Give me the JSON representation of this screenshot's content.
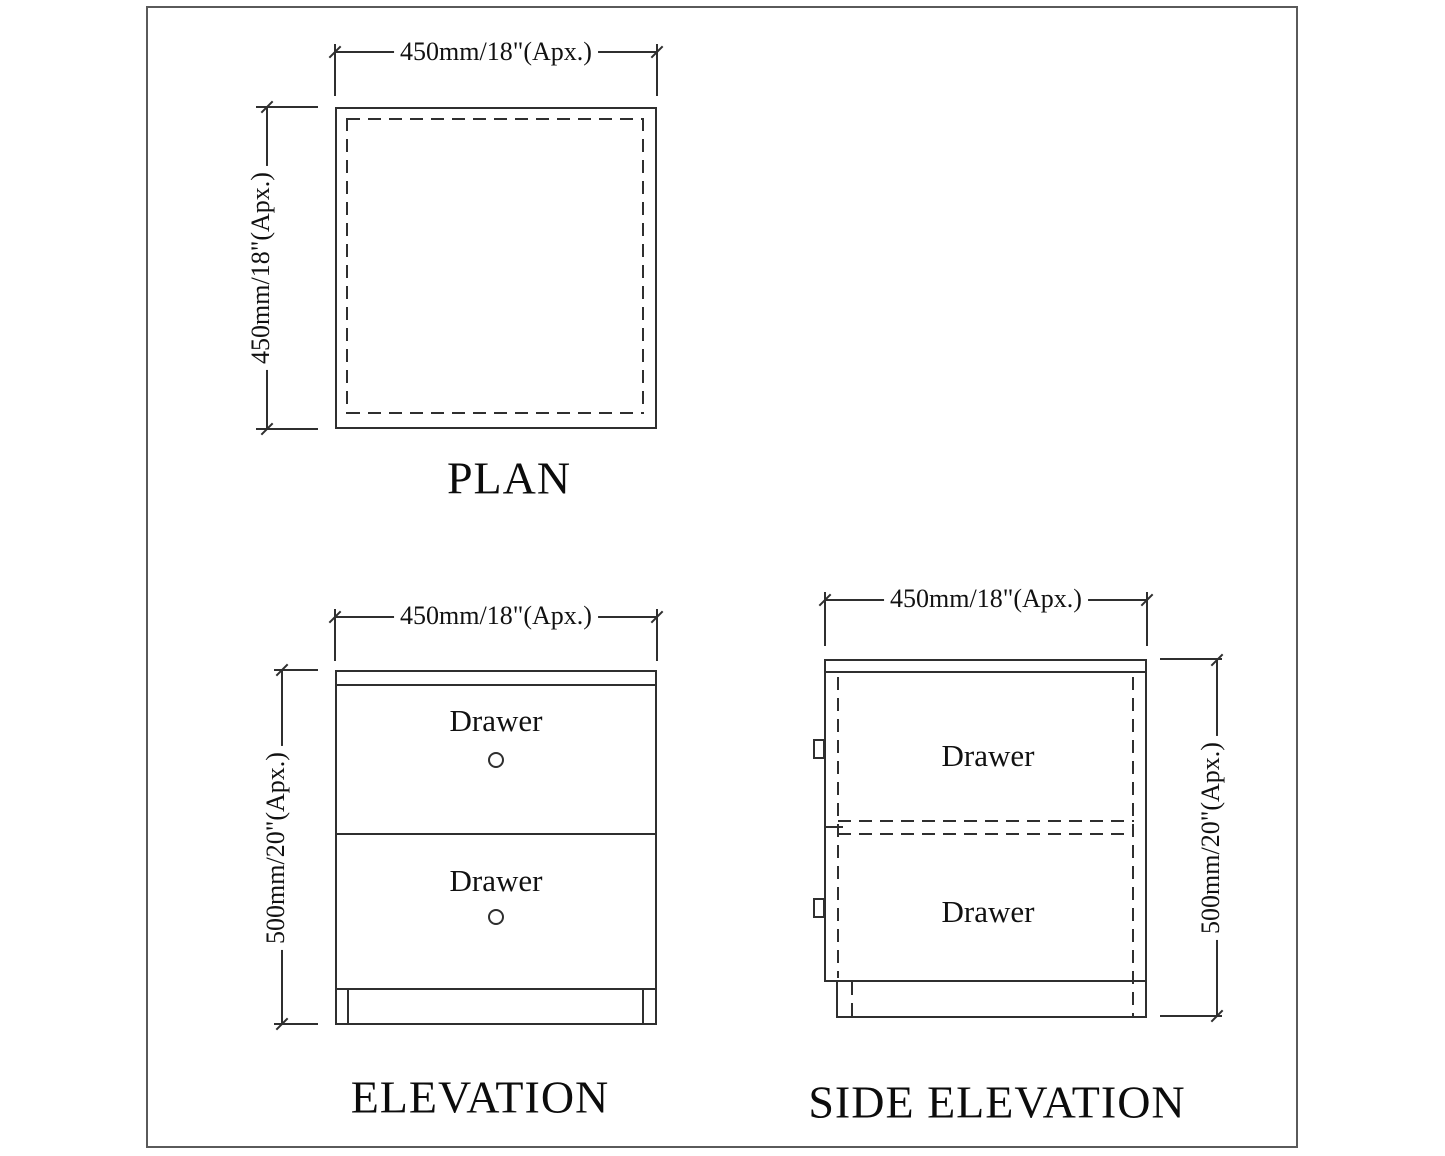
{
  "sheet": {
    "background": "#ffffff",
    "border_color": "#5a5a5a",
    "line_color": "#2f2f2f"
  },
  "views": {
    "plan": {
      "label": "PLAN",
      "width_dim": "450mm/18\"(Apx.)",
      "depth_dim": "450mm/18\"(Apx.)"
    },
    "elevation": {
      "label": "ELEVATION",
      "width_dim": "450mm/18\"(Apx.)",
      "height_dim": "500mm/20\"(Apx.)",
      "drawers": [
        "Drawer",
        "Drawer"
      ]
    },
    "side_elevation": {
      "label": "SIDE ELEVATION",
      "width_dim": "450mm/18\"(Apx.)",
      "height_dim": "500mm/20\"(Apx.)",
      "drawers": [
        "Drawer",
        "Drawer"
      ]
    }
  }
}
